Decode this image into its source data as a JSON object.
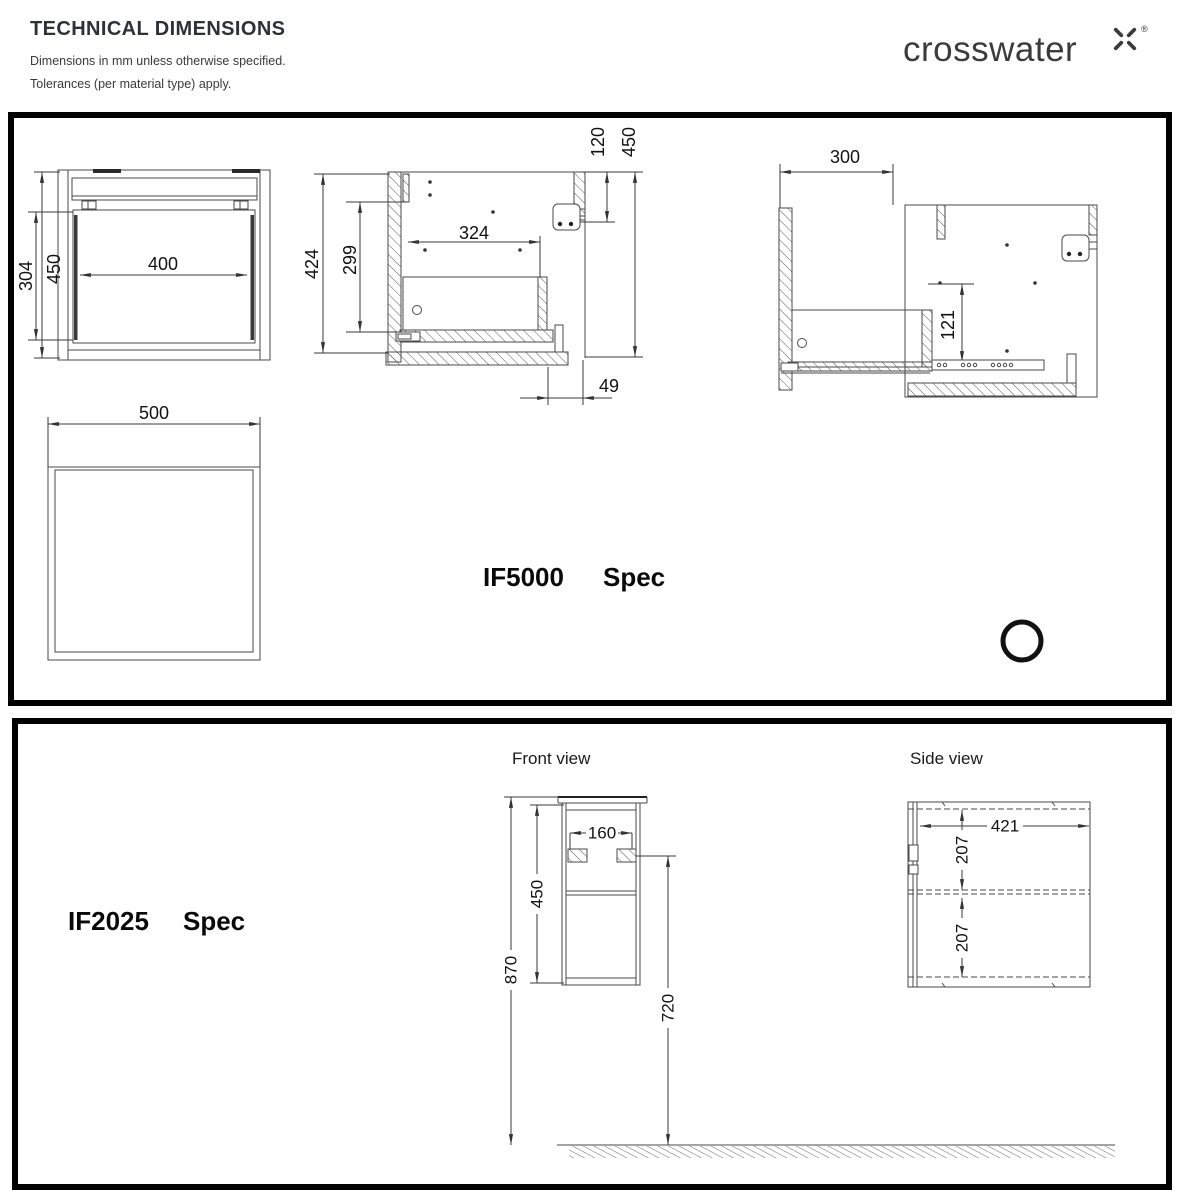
{
  "header": {
    "title": "TECHNICAL DIMENSIONS",
    "note1": "Dimensions in mm unless otherwise specified.",
    "note2": "Tolerances (per material type) apply.",
    "brand": "crosswater",
    "brand_mark": "®"
  },
  "if5000": {
    "name": "IF5000",
    "name_suffix": "Spec",
    "front": {
      "inner_width": "400",
      "inner_height": "304",
      "height": "450"
    },
    "section": {
      "height": "424",
      "drawer_height": "299",
      "inner_depth": "324",
      "bracket_offset": "120",
      "depth": "450",
      "toe_offset": "49"
    },
    "open": {
      "extension": "300",
      "drop": "121"
    },
    "plan": {
      "width": "500"
    }
  },
  "if2025": {
    "name": "IF2025",
    "name_suffix": "Spec",
    "front_view_label": "Front view",
    "side_view_label": "Side view",
    "front": {
      "hinge_span": "160",
      "carcass_height": "450",
      "overall_height": "870",
      "underside_height": "720"
    },
    "side": {
      "depth": "421",
      "top_section": "207",
      "bottom_section": "207"
    }
  }
}
